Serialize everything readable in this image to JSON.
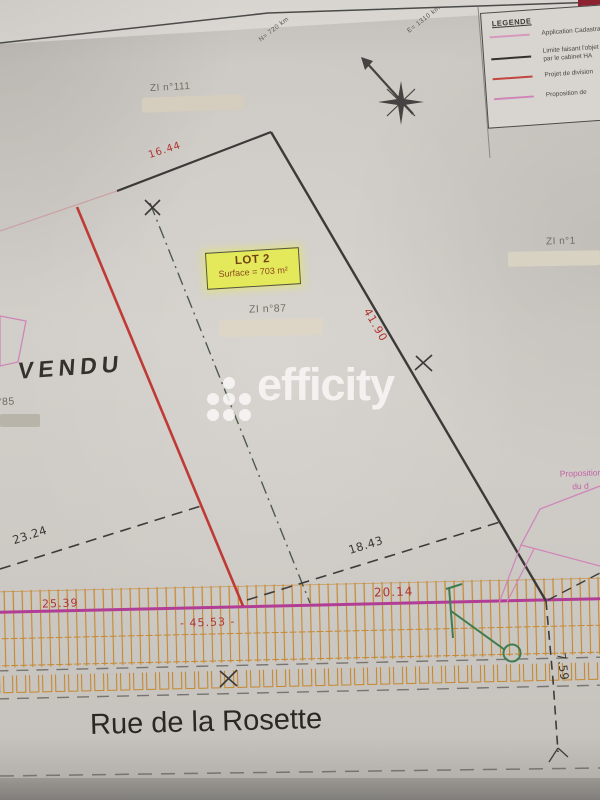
{
  "legend": {
    "title": "LEGENDE",
    "items": [
      {
        "label": "Application Cadastrale",
        "color": "#d698bd"
      },
      {
        "label": "Limite faisant l'objet",
        "label2": "par le cabinet HA",
        "color": "#33312e"
      },
      {
        "label": "Projet de division",
        "color": "#c24540"
      },
      {
        "label": "Proposition de",
        "color": "#cf86b8"
      }
    ]
  },
  "coordinates": {
    "north": "N= 720 km",
    "east": "E= 1310 km"
  },
  "parcels": {
    "zi111": "ZI n°111",
    "zi87": "ZI n°87",
    "zi1": "ZI n°1",
    "n85": "n°85"
  },
  "lot": {
    "title": "LOT 2",
    "surface": "Surface = 703 m²"
  },
  "notes": {
    "vendu": "VENDU",
    "proposition_line1": "Proposition",
    "proposition_line2": "du d"
  },
  "measurements": {
    "top": "16.44",
    "right": "41.90",
    "southwest": "23.24",
    "south": "18.43",
    "road_left": "25.39",
    "road_center": "- 45.53 -",
    "road_right": "20.14",
    "depth_right": "7.59"
  },
  "street": {
    "name": "Rue de la Rosette"
  },
  "watermark": {
    "brand": "efficity"
  },
  "colors": {
    "division_red": "#c03a35",
    "road_magenta": "#b13d95",
    "proposition_pink": "#cf86b8",
    "hatch_orange": "#c6882f",
    "survey_green": "#3f7d4e",
    "boundary_black": "#3c3a38",
    "lot_yellow": "#e4e95c"
  }
}
